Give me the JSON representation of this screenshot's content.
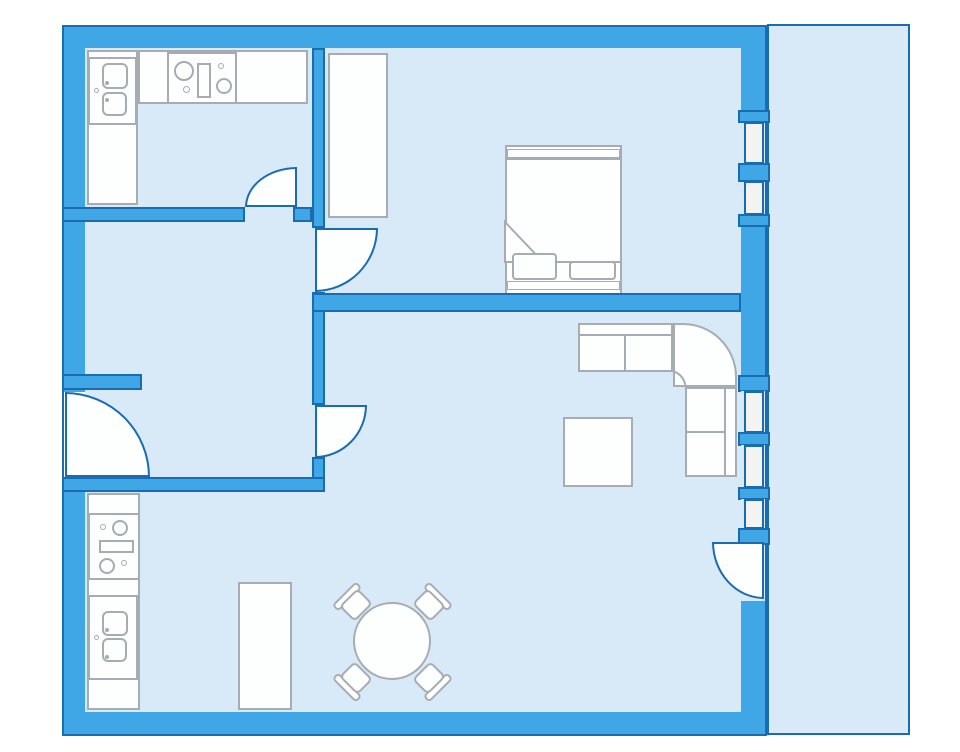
{
  "title": "apartment-floor-plan",
  "canvas": {
    "width": 960,
    "height": 752,
    "background": "#ffffff"
  },
  "palette": {
    "wall": "#3FA7E6",
    "outline": "#1A6CB0",
    "floor": "#D8EAF8",
    "pane": "#F3F4F2",
    "white": "#FDFEFE",
    "gray": "#A6ACB2"
  },
  "rooms": [
    {
      "name": "kitchen",
      "area": "top-left"
    },
    {
      "name": "hallway",
      "area": "middle-left"
    },
    {
      "name": "bedroom",
      "area": "top-right"
    },
    {
      "name": "living-dining-room",
      "area": "bottom"
    },
    {
      "name": "balcony",
      "area": "right"
    }
  ],
  "elements": [
    {
      "name": "building-shell",
      "type": "rect",
      "x": 62,
      "y": 25,
      "w": 705,
      "h": 711,
      "fill": "wall",
      "stroke": "outline",
      "sw": 2
    },
    {
      "name": "balcony-floor",
      "type": "rect",
      "x": 767,
      "y": 24,
      "w": 143,
      "h": 711,
      "fill": "floor",
      "stroke": "outline",
      "sw": 2
    },
    {
      "name": "interior-floor",
      "type": "rect",
      "x": 85,
      "y": 48,
      "w": 656,
      "h": 664,
      "fill": "floor",
      "sw": 0
    },
    {
      "name": "kitchen-counter-left",
      "type": "rect",
      "x": 87,
      "y": 50,
      "w": 51,
      "h": 155,
      "fill": "white",
      "stroke": "gray",
      "sw": 2
    },
    {
      "name": "kitchen-counter-top",
      "type": "rect",
      "x": 138,
      "y": 50,
      "w": 170,
      "h": 54,
      "fill": "white",
      "stroke": "gray",
      "sw": 2
    },
    {
      "name": "kitchen-sink-unit",
      "type": "rect",
      "x": 88,
      "y": 57,
      "w": 49,
      "h": 68,
      "fill": "white",
      "stroke": "gray",
      "sw": 2
    },
    {
      "name": "kitchen-sink-basin-upper",
      "type": "rect",
      "x": 102,
      "y": 63,
      "w": 26,
      "h": 26,
      "r": 6,
      "fill": "white",
      "stroke": "gray",
      "sw": 2
    },
    {
      "name": "kitchen-sink-basin-lower",
      "type": "rect",
      "x": 102,
      "y": 92,
      "w": 25,
      "h": 24,
      "r": 6,
      "fill": "white",
      "stroke": "gray",
      "sw": 2
    },
    {
      "name": "kitchen-sink-tap",
      "type": "circle",
      "cx": 96,
      "cy": 90,
      "rad": 2.5,
      "fill": "white",
      "stroke": "gray",
      "sw": 1.5
    },
    {
      "name": "kitchen-sink-drain-upper",
      "type": "circle",
      "cx": 107,
      "cy": 83,
      "rad": 2,
      "fill": "gray",
      "sw": 0
    },
    {
      "name": "kitchen-sink-drain-lower",
      "type": "circle",
      "cx": 107,
      "cy": 100,
      "rad": 2,
      "fill": "gray",
      "sw": 0
    },
    {
      "name": "kitchen-stove",
      "type": "rect",
      "x": 167,
      "y": 52,
      "w": 70,
      "h": 52,
      "fill": "white",
      "stroke": "gray",
      "sw": 2
    },
    {
      "name": "stove-burner-big-left",
      "type": "circle",
      "cx": 184,
      "cy": 71,
      "rad": 10,
      "fill": "white",
      "stroke": "gray",
      "sw": 2
    },
    {
      "name": "stove-burner-small-left",
      "type": "circle",
      "cx": 186,
      "cy": 89,
      "rad": 3.5,
      "fill": "white",
      "stroke": "gray",
      "sw": 1.5
    },
    {
      "name": "stove-drawer",
      "type": "rect",
      "x": 197,
      "y": 63,
      "w": 14,
      "h": 35,
      "fill": "white",
      "stroke": "gray",
      "sw": 2
    },
    {
      "name": "stove-burner-small-right",
      "type": "circle",
      "cx": 221,
      "cy": 66,
      "rad": 3,
      "fill": "white",
      "stroke": "gray",
      "sw": 1.5
    },
    {
      "name": "stove-burner-big-right",
      "type": "circle",
      "cx": 224,
      "cy": 86,
      "rad": 8,
      "fill": "white",
      "stroke": "gray",
      "sw": 2
    },
    {
      "name": "bedroom-wardrobe",
      "type": "rect",
      "x": 328,
      "y": 53,
      "w": 60,
      "h": 165,
      "fill": "white",
      "stroke": "gray",
      "sw": 2
    },
    {
      "name": "bed-frame",
      "type": "rect",
      "x": 505,
      "y": 145,
      "w": 117,
      "h": 150,
      "fill": "white",
      "stroke": "gray",
      "sw": 2
    },
    {
      "name": "bed-head-band",
      "type": "rect",
      "x": 507,
      "y": 149,
      "w": 113,
      "h": 9,
      "fill": "white",
      "stroke": "gray",
      "sw": 1.5
    },
    {
      "name": "bed-blanket",
      "type": "rect",
      "x": 505,
      "y": 158,
      "w": 117,
      "h": 105,
      "fill": "white",
      "stroke": "gray",
      "sw": 2
    },
    {
      "name": "bed-blanket-fold",
      "type": "svg",
      "x": 504,
      "y": 221,
      "w": 41,
      "h": 43,
      "path": "M1 1 L39 41 L1 41 Z",
      "fill": "white",
      "stroke": "gray",
      "sw": 2
    },
    {
      "name": "bed-pillow-left",
      "type": "rect",
      "x": 512,
      "y": 253,
      "w": 45,
      "h": 27,
      "r": 4,
      "fill": "white",
      "stroke": "gray",
      "sw": 2
    },
    {
      "name": "bed-pillow-right",
      "type": "rect",
      "x": 569,
      "y": 261,
      "w": 47,
      "h": 19,
      "r": 4,
      "fill": "white",
      "stroke": "gray",
      "sw": 2
    },
    {
      "name": "bed-foot-band",
      "type": "rect",
      "x": 507,
      "y": 281,
      "w": 113,
      "h": 9,
      "fill": "white",
      "stroke": "gray",
      "sw": 1.5
    },
    {
      "name": "sofa-top-section",
      "type": "rect",
      "x": 578,
      "y": 323,
      "w": 95,
      "h": 49,
      "fill": "white",
      "stroke": "gray",
      "sw": 2
    },
    {
      "name": "sofa-top-back-line",
      "type": "rect",
      "x": 579,
      "y": 334,
      "w": 94,
      "h": 2,
      "fill": "gray",
      "sw": 0
    },
    {
      "name": "sofa-top-seat-divider",
      "type": "rect",
      "x": 624,
      "y": 336,
      "w": 2,
      "h": 35,
      "fill": "gray",
      "sw": 0
    },
    {
      "name": "sofa-corner-section",
      "type": "rect",
      "x": 673,
      "y": 323,
      "w": 64,
      "h": 64,
      "radii": "0 54px 0 0",
      "fill": "white",
      "stroke": "gray",
      "sw": 2
    },
    {
      "name": "sofa-corner-inner-curve",
      "type": "svg",
      "x": 671,
      "y": 370,
      "w": 17,
      "h": 19,
      "path": "M1 1 Q13 4 15 18",
      "fill": "none",
      "stroke": "gray",
      "sw": 2
    },
    {
      "name": "sofa-right-section",
      "type": "rect",
      "x": 685,
      "y": 387,
      "w": 52,
      "h": 90,
      "fill": "white",
      "stroke": "gray",
      "sw": 2
    },
    {
      "name": "sofa-right-back-line",
      "type": "rect",
      "x": 724,
      "y": 388,
      "w": 2,
      "h": 88,
      "fill": "gray",
      "sw": 0
    },
    {
      "name": "sofa-right-seat-divider",
      "type": "rect",
      "x": 686,
      "y": 431,
      "w": 38,
      "h": 2,
      "fill": "gray",
      "sw": 0
    },
    {
      "name": "coffee-table",
      "type": "rect",
      "x": 563,
      "y": 417,
      "w": 70,
      "h": 70,
      "fill": "white",
      "stroke": "gray",
      "sw": 2
    },
    {
      "name": "dining-cabinet",
      "type": "rect",
      "x": 238,
      "y": 582,
      "w": 54,
      "h": 128,
      "fill": "white",
      "stroke": "gray",
      "sw": 2
    },
    {
      "name": "chair-nw-back",
      "type": "rect",
      "x": 330,
      "y": 592,
      "w": 34,
      "h": 9,
      "r": 4,
      "rot": -45,
      "fill": "white",
      "stroke": "gray",
      "sw": 2
    },
    {
      "name": "chair-nw-seat",
      "type": "rect",
      "x": 343,
      "y": 594,
      "w": 26,
      "h": 22,
      "r": 5,
      "rot": -45,
      "fill": "white",
      "stroke": "gray",
      "sw": 2
    },
    {
      "name": "chair-ne-back",
      "type": "rect",
      "x": 421,
      "y": 592,
      "w": 34,
      "h": 9,
      "r": 4,
      "rot": 45,
      "fill": "white",
      "stroke": "gray",
      "sw": 2
    },
    {
      "name": "chair-ne-seat",
      "type": "rect",
      "x": 416,
      "y": 594,
      "w": 26,
      "h": 22,
      "r": 5,
      "rot": 45,
      "fill": "white",
      "stroke": "gray",
      "sw": 2
    },
    {
      "name": "chair-sw-back",
      "type": "rect",
      "x": 330,
      "y": 683,
      "w": 34,
      "h": 9,
      "r": 4,
      "rot": 45,
      "fill": "white",
      "stroke": "gray",
      "sw": 2
    },
    {
      "name": "chair-sw-seat",
      "type": "rect",
      "x": 343,
      "y": 667,
      "w": 26,
      "h": 22,
      "r": 5,
      "rot": 45,
      "fill": "white",
      "stroke": "gray",
      "sw": 2
    },
    {
      "name": "chair-se-back",
      "type": "rect",
      "x": 421,
      "y": 683,
      "w": 34,
      "h": 9,
      "r": 4,
      "rot": -45,
      "fill": "white",
      "stroke": "gray",
      "sw": 2
    },
    {
      "name": "chair-se-seat",
      "type": "rect",
      "x": 416,
      "y": 667,
      "w": 26,
      "h": 22,
      "r": 5,
      "rot": -45,
      "fill": "white",
      "stroke": "gray",
      "sw": 2
    },
    {
      "name": "dining-table",
      "type": "circle",
      "cx": 392,
      "cy": 641,
      "rad": 39,
      "fill": "white",
      "stroke": "gray",
      "sw": 2
    },
    {
      "name": "utility-counter",
      "type": "rect",
      "x": 87,
      "y": 493,
      "w": 53,
      "h": 217,
      "fill": "white",
      "stroke": "gray",
      "sw": 2
    },
    {
      "name": "utility-cooktop",
      "type": "rect",
      "x": 88,
      "y": 513,
      "w": 52,
      "h": 67,
      "fill": "white",
      "stroke": "gray",
      "sw": 2
    },
    {
      "name": "utility-burner-small-top",
      "type": "circle",
      "cx": 103,
      "cy": 527,
      "rad": 3,
      "fill": "white",
      "stroke": "gray",
      "sw": 1.5
    },
    {
      "name": "utility-burner-big-top",
      "type": "circle",
      "cx": 120,
      "cy": 528,
      "rad": 8,
      "fill": "white",
      "stroke": "gray",
      "sw": 2
    },
    {
      "name": "utility-cooktop-drawer",
      "type": "rect",
      "x": 99,
      "y": 540,
      "w": 35,
      "h": 13,
      "fill": "white",
      "stroke": "gray",
      "sw": 2
    },
    {
      "name": "utility-burner-big-bottom",
      "type": "circle",
      "cx": 107,
      "cy": 566,
      "rad": 8,
      "fill": "white",
      "stroke": "gray",
      "sw": 2
    },
    {
      "name": "utility-burner-small-bottom",
      "type": "circle",
      "cx": 124,
      "cy": 563,
      "rad": 3,
      "fill": "white",
      "stroke": "gray",
      "sw": 1.5
    },
    {
      "name": "utility-sink-unit",
      "type": "rect",
      "x": 88,
      "y": 595,
      "w": 50,
      "h": 85,
      "fill": "white",
      "stroke": "gray",
      "sw": 2
    },
    {
      "name": "utility-sink-basin-upper",
      "type": "rect",
      "x": 102,
      "y": 611,
      "w": 26,
      "h": 25,
      "r": 6,
      "fill": "white",
      "stroke": "gray",
      "sw": 2
    },
    {
      "name": "utility-sink-basin-lower",
      "type": "rect",
      "x": 102,
      "y": 638,
      "w": 25,
      "h": 24,
      "r": 6,
      "fill": "white",
      "stroke": "gray",
      "sw": 2
    },
    {
      "name": "utility-sink-tap",
      "type": "circle",
      "cx": 96,
      "cy": 637,
      "rad": 2.5,
      "fill": "white",
      "stroke": "gray",
      "sw": 1.5
    },
    {
      "name": "utility-sink-drain-upper",
      "type": "circle",
      "cx": 107,
      "cy": 630,
      "rad": 2,
      "fill": "gray",
      "sw": 0
    },
    {
      "name": "utility-sink-drain-lower",
      "type": "circle",
      "cx": 107,
      "cy": 657,
      "rad": 2,
      "fill": "gray",
      "sw": 0
    },
    {
      "name": "spine-wall-upper",
      "type": "rect",
      "x": 312,
      "y": 48,
      "w": 13,
      "h": 180,
      "fill": "wall",
      "stroke": "outline",
      "sw": 2
    },
    {
      "name": "kitchen-south-wall",
      "type": "rect",
      "x": 62,
      "y": 207,
      "w": 183,
      "h": 15,
      "fill": "wall",
      "stroke": "outline",
      "sw": 2
    },
    {
      "name": "kitchen-south-wall-stub",
      "type": "rect",
      "x": 293,
      "y": 207,
      "w": 19,
      "h": 15,
      "fill": "wall",
      "stroke": "outline",
      "sw": 2
    },
    {
      "name": "spine-wall-middle",
      "type": "rect",
      "x": 312,
      "y": 292,
      "w": 13,
      "h": 113,
      "fill": "wall",
      "stroke": "outline",
      "sw": 2
    },
    {
      "name": "room-divider-wall",
      "type": "rect",
      "x": 312,
      "y": 293,
      "w": 429,
      "h": 19,
      "fill": "wall",
      "stroke": "outline",
      "sw": 2
    },
    {
      "name": "spine-wall-lower",
      "type": "rect",
      "x": 312,
      "y": 457,
      "w": 13,
      "h": 35,
      "fill": "wall",
      "stroke": "outline",
      "sw": 2
    },
    {
      "name": "hallway-south-wall",
      "type": "rect",
      "x": 62,
      "y": 477,
      "w": 263,
      "h": 15,
      "fill": "wall",
      "stroke": "outline",
      "sw": 2
    },
    {
      "name": "entry-stub-wall",
      "type": "rect",
      "x": 62,
      "y": 374,
      "w": 80,
      "h": 16,
      "fill": "wall",
      "stroke": "outline",
      "sw": 2
    },
    {
      "name": "upper-window-gap-1",
      "type": "rect",
      "x": 741,
      "y": 122,
      "w": 24,
      "h": 42,
      "fill": "floor",
      "sw": 0
    },
    {
      "name": "upper-window-gap-2",
      "type": "rect",
      "x": 741,
      "y": 181,
      "w": 24,
      "h": 34,
      "fill": "floor",
      "sw": 0
    },
    {
      "name": "upper-window-pane-1",
      "type": "rect",
      "x": 744,
      "y": 122,
      "w": 20,
      "h": 42,
      "fill": "pane",
      "stroke": "outline",
      "sw": 2
    },
    {
      "name": "upper-window-pane-2",
      "type": "rect",
      "x": 744,
      "y": 181,
      "w": 20,
      "h": 34,
      "fill": "pane",
      "stroke": "outline",
      "sw": 2
    },
    {
      "name": "upper-window-sill-top",
      "type": "rect",
      "x": 738,
      "y": 110,
      "w": 32,
      "h": 13,
      "fill": "wall",
      "stroke": "outline",
      "sw": 2
    },
    {
      "name": "upper-window-mullion",
      "type": "rect",
      "x": 738,
      "y": 163,
      "w": 32,
      "h": 19,
      "fill": "wall",
      "stroke": "outline",
      "sw": 2
    },
    {
      "name": "upper-window-sill-bottom",
      "type": "rect",
      "x": 738,
      "y": 214,
      "w": 32,
      "h": 13,
      "fill": "wall",
      "stroke": "outline",
      "sw": 2
    },
    {
      "name": "lower-window-sill-top",
      "type": "rect",
      "x": 738,
      "y": 375,
      "w": 32,
      "h": 17,
      "fill": "wall",
      "stroke": "outline",
      "sw": 2
    },
    {
      "name": "lower-window-gap-1",
      "type": "rect",
      "x": 741,
      "y": 391,
      "w": 24,
      "h": 42,
      "fill": "floor",
      "sw": 0
    },
    {
      "name": "lower-window-pane-1",
      "type": "rect",
      "x": 744,
      "y": 391,
      "w": 20,
      "h": 42,
      "fill": "pane",
      "stroke": "outline",
      "sw": 2
    },
    {
      "name": "lower-window-mullion-1",
      "type": "rect",
      "x": 738,
      "y": 432,
      "w": 32,
      "h": 14,
      "fill": "wall",
      "stroke": "outline",
      "sw": 2
    },
    {
      "name": "lower-window-gap-2",
      "type": "rect",
      "x": 741,
      "y": 445,
      "w": 24,
      "h": 43,
      "fill": "floor",
      "sw": 0
    },
    {
      "name": "lower-window-pane-2",
      "type": "rect",
      "x": 744,
      "y": 445,
      "w": 20,
      "h": 43,
      "fill": "pane",
      "stroke": "outline",
      "sw": 2
    },
    {
      "name": "lower-window-mullion-2",
      "type": "rect",
      "x": 738,
      "y": 487,
      "w": 32,
      "h": 13,
      "fill": "wall",
      "stroke": "outline",
      "sw": 2
    },
    {
      "name": "lower-window-gap-3",
      "type": "rect",
      "x": 741,
      "y": 499,
      "w": 24,
      "h": 30,
      "fill": "floor",
      "sw": 0
    },
    {
      "name": "lower-window-pane-3",
      "type": "rect",
      "x": 744,
      "y": 499,
      "w": 20,
      "h": 30,
      "fill": "pane",
      "stroke": "outline",
      "sw": 2
    },
    {
      "name": "lower-window-sill-bottom",
      "type": "rect",
      "x": 738,
      "y": 528,
      "w": 32,
      "h": 17,
      "fill": "wall",
      "stroke": "outline",
      "sw": 2
    },
    {
      "name": "balcony-door-gap",
      "type": "rect",
      "x": 741,
      "y": 545,
      "w": 24,
      "h": 56,
      "fill": "floor",
      "sw": 0
    },
    {
      "name": "entrance-door-gap",
      "type": "rect",
      "x": 64,
      "y": 392,
      "w": 21,
      "h": 85,
      "fill": "#ffffff",
      "sw": 0
    },
    {
      "name": "kitchen-door-arc",
      "type": "door",
      "corner": "tl",
      "x": 245,
      "y": 167,
      "w": 52,
      "h": 40,
      "fill": "white",
      "stroke": "outline",
      "sw": 2.5
    },
    {
      "name": "bedroom-door-arc",
      "type": "door",
      "corner": "br",
      "x": 315,
      "y": 228,
      "w": 63,
      "h": 64,
      "fill": "white",
      "stroke": "outline",
      "sw": 2.5
    },
    {
      "name": "living-room-door-arc",
      "type": "door",
      "corner": "br",
      "x": 315,
      "y": 405,
      "w": 52,
      "h": 53,
      "fill": "white",
      "stroke": "outline",
      "sw": 2.5
    },
    {
      "name": "balcony-door-arc",
      "type": "door",
      "corner": "bl",
      "x": 712,
      "y": 542,
      "w": 52,
      "h": 57,
      "fill": "white",
      "stroke": "outline",
      "sw": 2.5
    },
    {
      "name": "entrance-door-arc",
      "type": "door",
      "corner": "tr",
      "x": 65,
      "y": 392,
      "w": 85,
      "h": 85,
      "fill": "white",
      "stroke": "outline",
      "sw": 2.5
    }
  ]
}
